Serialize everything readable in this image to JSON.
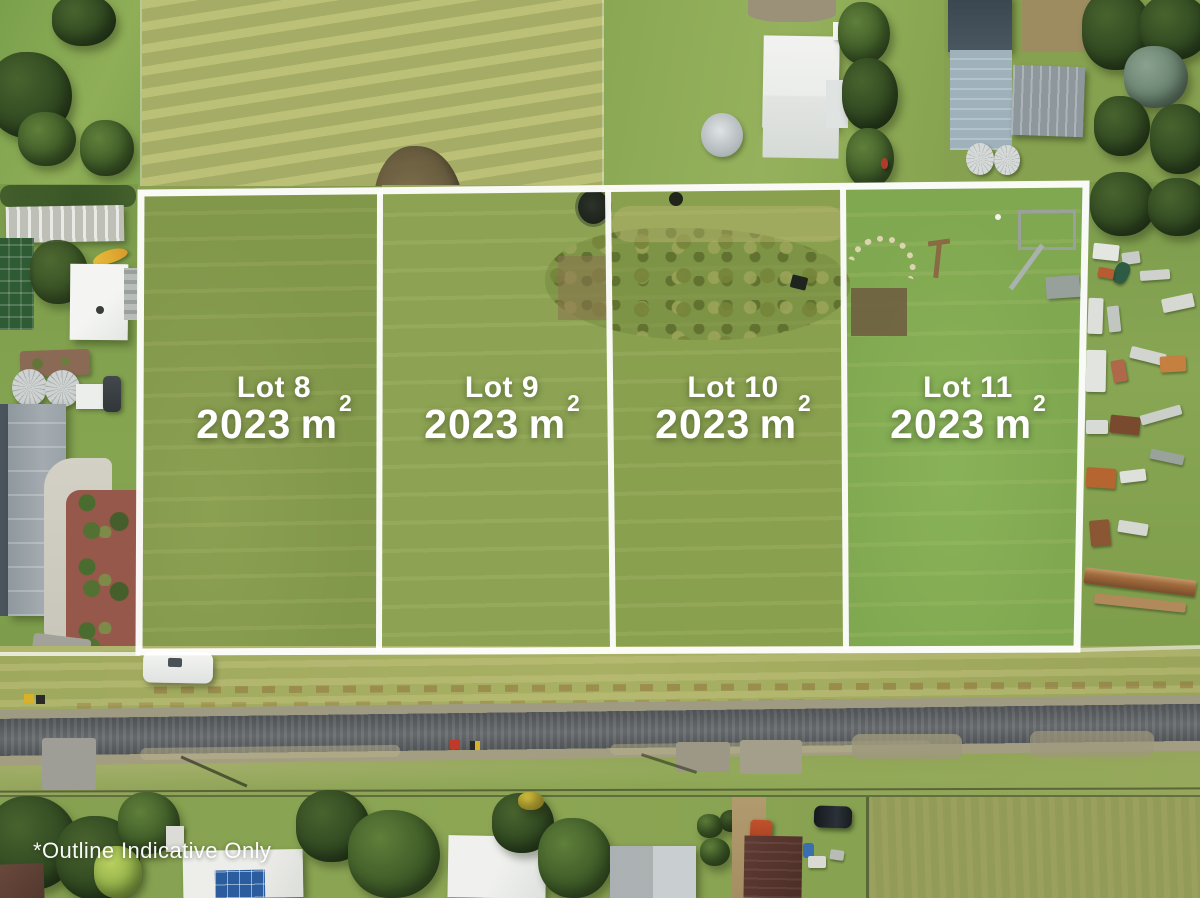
{
  "photo": {
    "type": "aerial-drone-photograph",
    "description": "Aerial view of a four-lot land subdivision outlined in white over grass paddocks, with a road and houses below",
    "disclaimer": "*Outline Indicative Only"
  },
  "lots": [
    {
      "label": "Lot 8",
      "area_value": "2023",
      "area_unit": "m",
      "area_sup": "2"
    },
    {
      "label": "Lot 9",
      "area_value": "2023",
      "area_unit": "m",
      "area_sup": "2"
    },
    {
      "label": "Lot 10",
      "area_value": "2023",
      "area_unit": "m",
      "area_sup": "2"
    },
    {
      "label": "Lot 11",
      "area_value": "2023",
      "area_unit": "m",
      "area_sup": "2"
    }
  ],
  "colors": {
    "boundary_line": "#ffffff",
    "label_text": "#ffffff",
    "mown_field": "#aeb46e",
    "lot_grass": "#87a04f",
    "road_asphalt": "#5f6366",
    "mulch_garden": "#96584a",
    "solar_panel": "#2b5d9e"
  }
}
